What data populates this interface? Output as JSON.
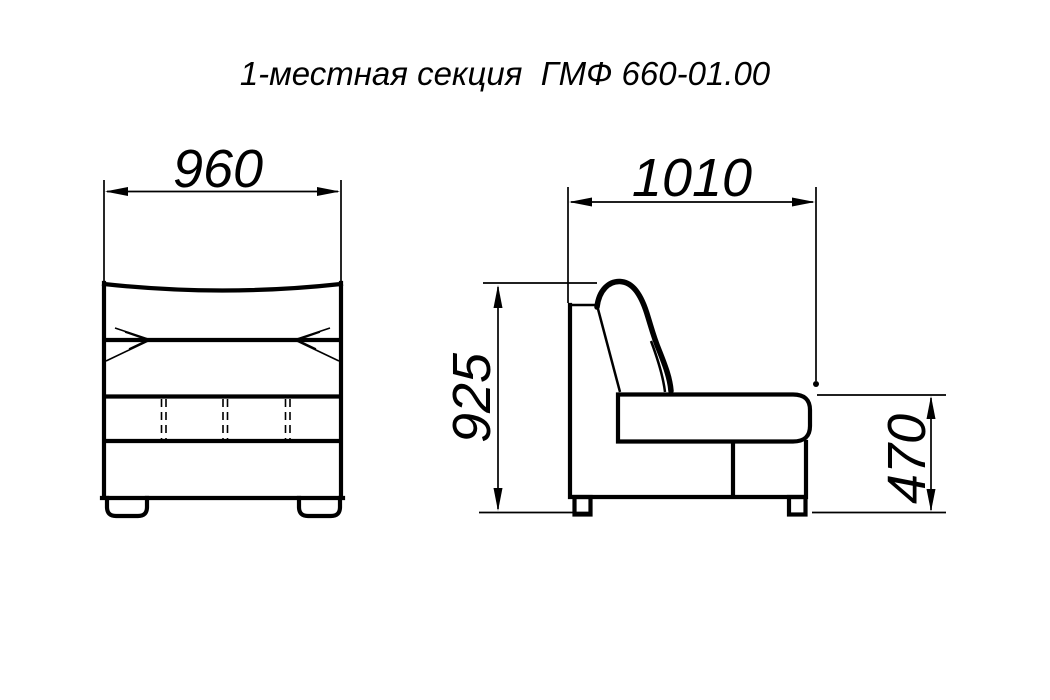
{
  "title": "1-местная секция  ГМФ 660-01.00",
  "dimensions": {
    "front_width": "960",
    "side_depth": "1010",
    "overall_height": "925",
    "seat_height": "470"
  },
  "colors": {
    "line": "#000000",
    "background": "#ffffff"
  }
}
